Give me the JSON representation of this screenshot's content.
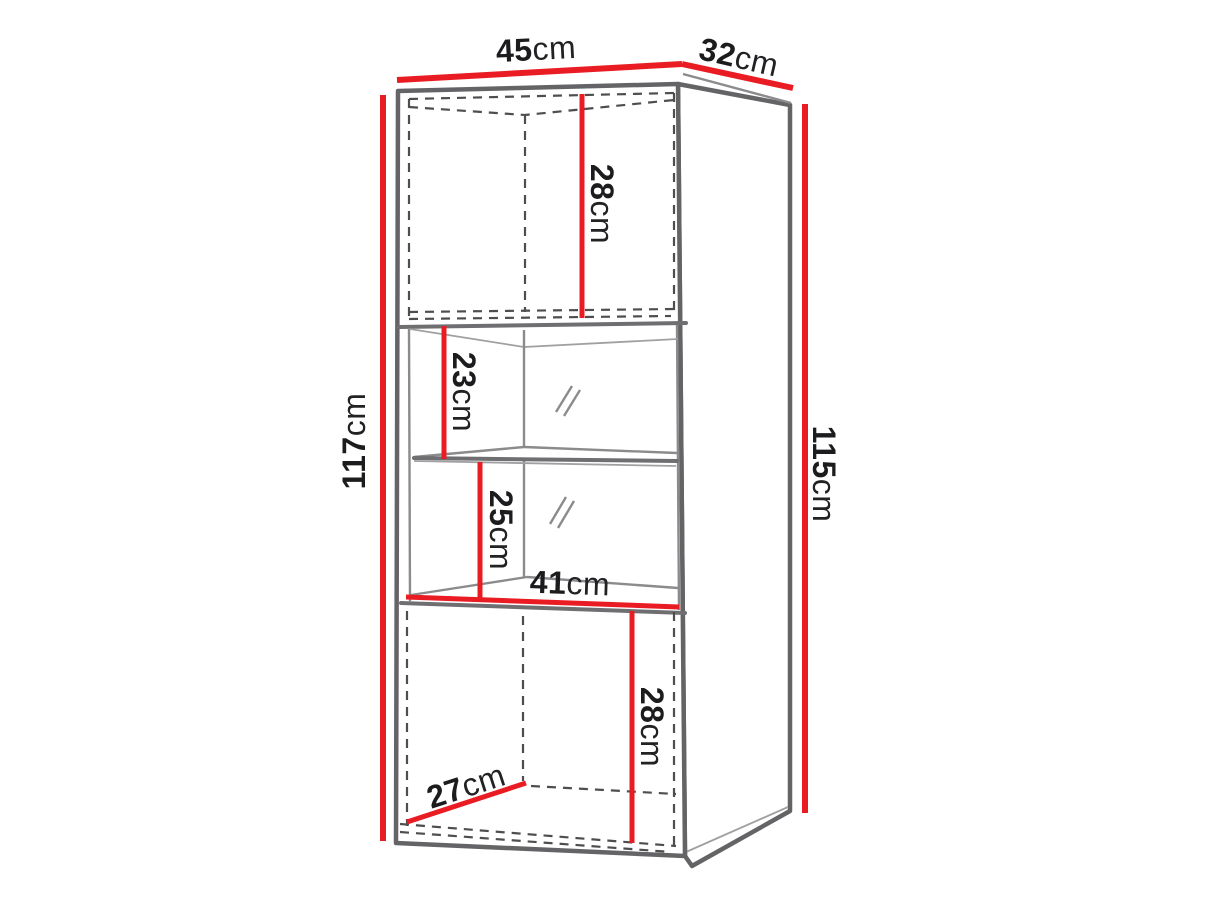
{
  "diagram": {
    "subject": "display cabinet dimension drawing",
    "background_color": "#ffffff",
    "dimension_line_color": "#ea1c23",
    "outline_color": "#646467",
    "hidden_edge_color": "#4e4e4e",
    "label_color": "#1c1c1e",
    "labels": {
      "width": {
        "value": "45",
        "unit": "cm"
      },
      "depth": {
        "value": "32",
        "unit": "cm"
      },
      "height_front": {
        "value": "117",
        "unit": "cm"
      },
      "height_side": {
        "value": "115",
        "unit": "cm"
      },
      "top_door_height": {
        "value": "28",
        "unit": "cm"
      },
      "upper_compartment_height": {
        "value": "23",
        "unit": "cm"
      },
      "lower_compartment_height": {
        "value": "25",
        "unit": "cm"
      },
      "interior_width": {
        "value": "41",
        "unit": "cm"
      },
      "bottom_door_height": {
        "value": "28",
        "unit": "cm"
      },
      "bottom_interior_depth": {
        "value": "27",
        "unit": "cm"
      }
    }
  }
}
